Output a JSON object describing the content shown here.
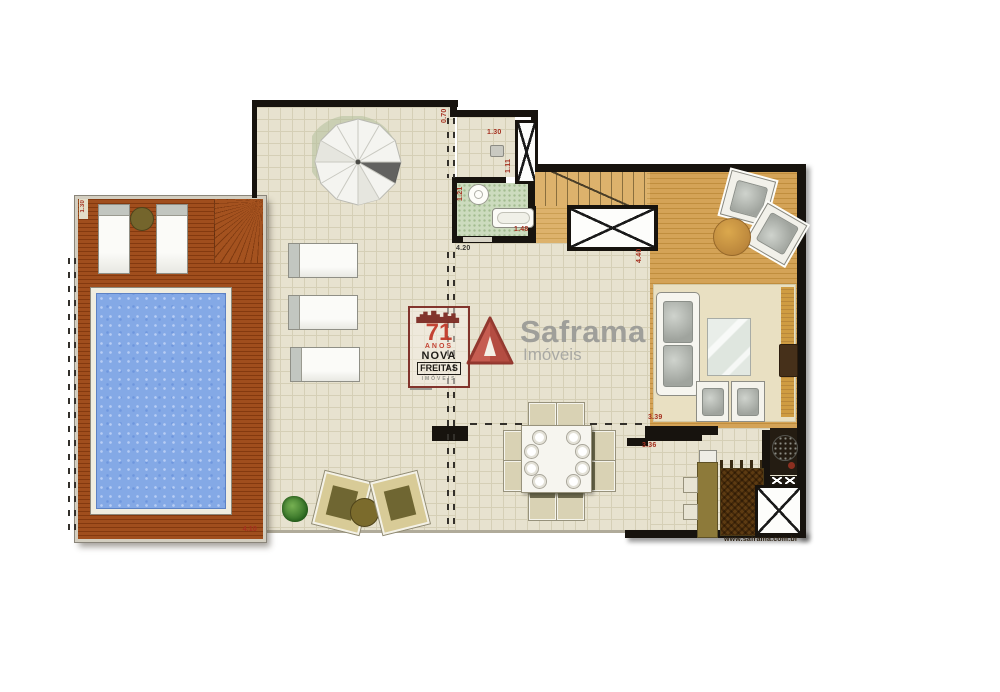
{
  "watermark": {
    "badge": {
      "years": "71",
      "anos": "ANOS",
      "nova": "NOVA",
      "freitas": "FREITAS",
      "imoveis": "IMÓVEIS"
    },
    "brand": {
      "name": "Saframa",
      "type": "Imóveis"
    },
    "url": "www.saframa.com.br"
  },
  "dims": {
    "wall_top": "0.70",
    "vestibule_w": "1.30",
    "vestibule_h": "1.11",
    "bath_h": "1.21",
    "bath_w": "1.48",
    "patio_w": "4.20",
    "living_h": "4.40",
    "living_w": "3.39",
    "kitchen_w": "3.36",
    "pool_deck_w": "4.10",
    "deck_h": "1.30"
  },
  "colors": {
    "deck_wood": "#9c4a1c",
    "pool_water": "#84a9e6",
    "patio_tile": "#e7e2cf",
    "interior_wood": "#d2a156",
    "bathroom_floor": "#ccdbbe",
    "wall": "#17130e",
    "dimension_text": "#a5301f",
    "brand_red": "#c5564b",
    "brand_gray": "#9c9c98"
  }
}
